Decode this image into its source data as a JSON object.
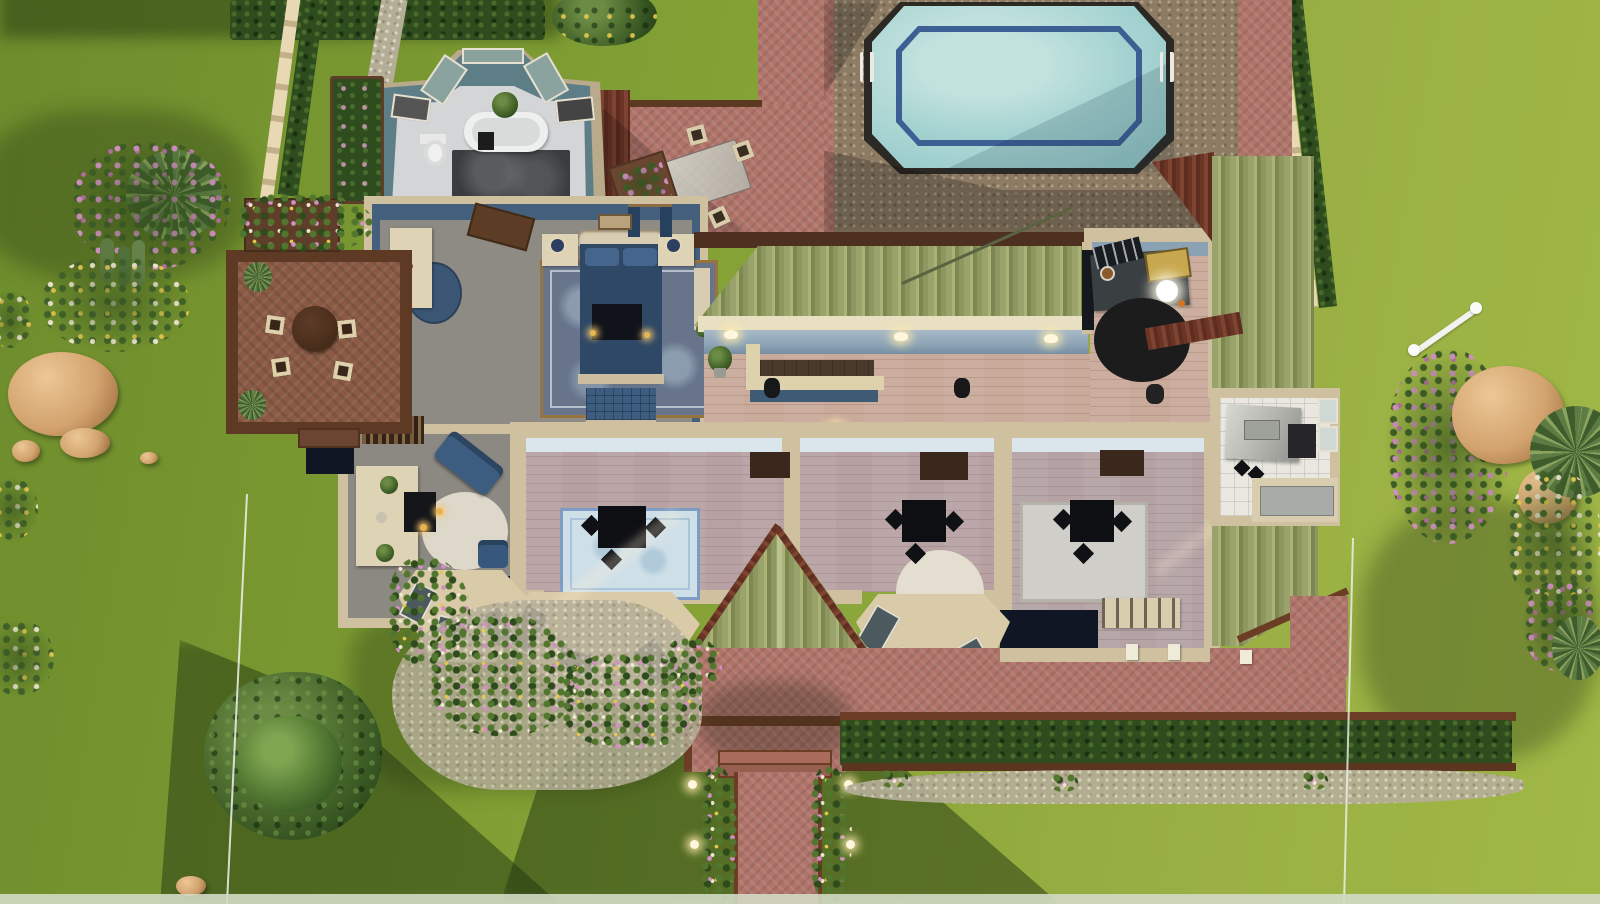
{
  "app": {
    "name": "life-simulation build mode",
    "view": "top-down aerial view of a residential lot",
    "visible_text": "none"
  },
  "scene": {
    "areas": [
      "lawn",
      "swimming-pool",
      "pool-deck",
      "brick-patio",
      "outdoor-dining-set",
      "master-bathroom",
      "master-bedroom",
      "living-room",
      "bar-hall",
      "drafting-study",
      "office-room-1",
      "office-room-2",
      "office-room-3",
      "kitchenette",
      "wood-deck",
      "center-gable-roof",
      "bar-roof",
      "right-roof",
      "front-porch",
      "front-walkway",
      "hedge-row",
      "flower-gardens",
      "lot-boundary-lines"
    ]
  },
  "colors": {
    "grass_light": "#9ab044",
    "grass_mid": "#82a034",
    "grass_dark": "#6d8c2c",
    "pool_water": "#a3d2d0",
    "pool_tile_line": "#3c5f94",
    "pool_deck": "#8d7b64",
    "brick_patio": "#b0746a",
    "roof_shingle": "#98a26a",
    "roof_red": "#6e3a2a",
    "wall_cream": "#cfc09f",
    "deck_wood": "#8a5a45",
    "deck_trim": "#5e3a24",
    "hall_floor": "#c9aa9b",
    "office_floor": "#b7a1a3",
    "bedroom_floor": "#8e8a84",
    "interior_navy": "#44607d",
    "hall_wall_blue": "#8ba2b4",
    "bathroom_teal": "#5e7e87",
    "rug_blue": "#cfdfe8",
    "sofa_navy": "#3c5c80",
    "hedge_green": "#2e4c1e",
    "tree_green": "#3c5d26",
    "flower_pink": "#d490c4",
    "flower_yellow": "#e6c84e",
    "flower_white": "#efe8d2",
    "rock_tan": "#d2a36e",
    "light_warm": "#fff6dd"
  }
}
